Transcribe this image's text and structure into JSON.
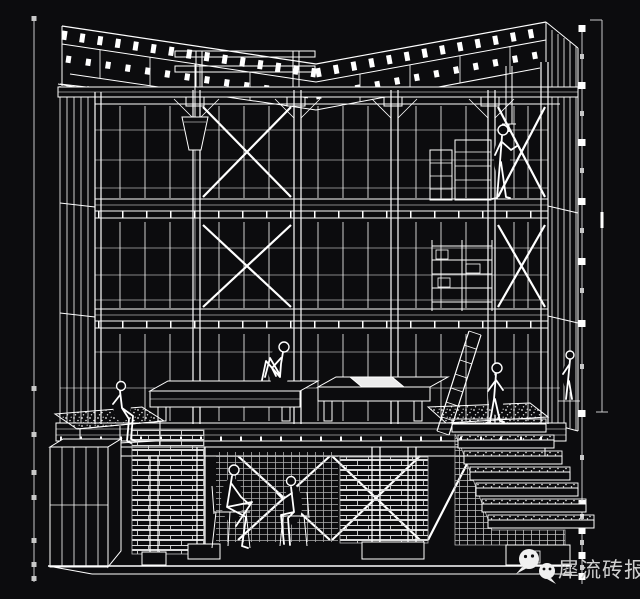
{
  "colors": {
    "background": "#0c0c0e",
    "line": "#ffffff",
    "line_dim": "#c9c9c9",
    "watermark_text": "#cfcfcf",
    "bubble": "#f0f0f0"
  },
  "watermark": {
    "icon": "wechat-icon",
    "text": "犀流砖报"
  },
  "drawing": {
    "type": "architectural-sectional-axonometric-line-drawing",
    "style": "white-lines-on-black",
    "elements": [
      "roof-trusses",
      "floor-slabs",
      "columns",
      "window-mullions",
      "x-bracing",
      "benches",
      "planter-table",
      "storage-cabinet",
      "brick-walls",
      "basement-columns",
      "stairs",
      "ladder",
      "shelf-rack",
      "hanging-hopper",
      "ground-line"
    ],
    "people": [
      "sitting-on-platform",
      "sitting-on-planter",
      "standing-third-floor",
      "standing-at-stairs",
      "sitting-on-chair-left",
      "sitting-on-chair-right",
      "standing-right-edge"
    ],
    "annotations": [
      "left-guide-line",
      "right-scale-bar",
      "right-dimension-line"
    ]
  }
}
